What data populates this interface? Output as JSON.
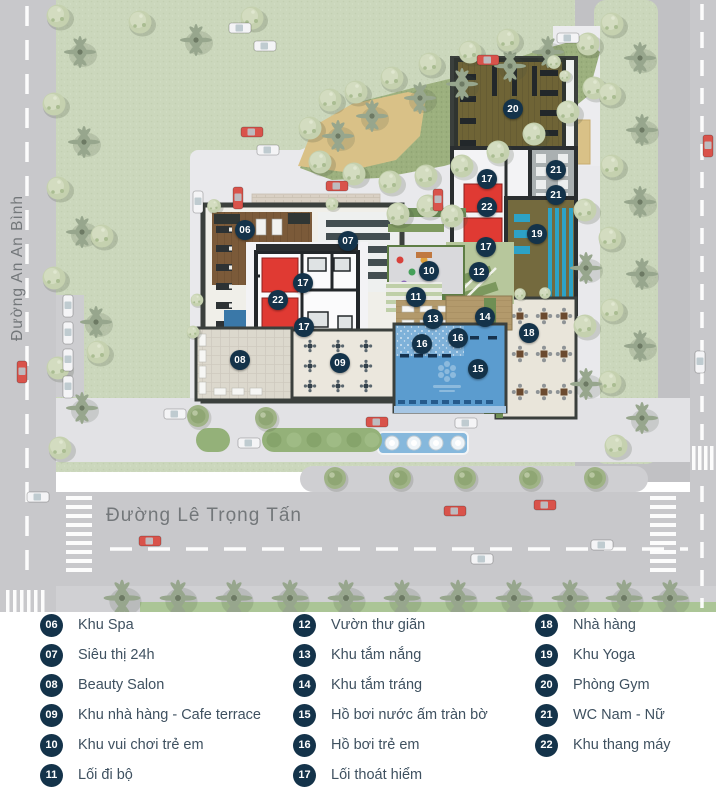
{
  "map": {
    "road_left_label": "Đường An An Bình",
    "road_bottom_label": "Đường Lê Trọng Tấn",
    "markers": [
      {
        "label": "06"
      },
      {
        "label": "07"
      },
      {
        "label": "17"
      },
      {
        "label": "22"
      },
      {
        "label": "17"
      },
      {
        "label": "08"
      },
      {
        "label": "09"
      },
      {
        "label": "20"
      },
      {
        "label": "17"
      },
      {
        "label": "21"
      },
      {
        "label": "21"
      },
      {
        "label": "22"
      },
      {
        "label": "19"
      },
      {
        "label": "17"
      },
      {
        "label": "10"
      },
      {
        "label": "12"
      },
      {
        "label": "11"
      },
      {
        "label": "13"
      },
      {
        "label": "14"
      },
      {
        "label": "16"
      },
      {
        "label": "16"
      },
      {
        "label": "15"
      },
      {
        "label": "18"
      }
    ]
  },
  "legend": {
    "columns": [
      {
        "items": [
          {
            "num": "06",
            "label": "Khu Spa"
          },
          {
            "num": "07",
            "label": "Siêu thị 24h"
          },
          {
            "num": "08",
            "label": "Beauty Salon"
          },
          {
            "num": "09",
            "label": "Khu nhà hàng - Cafe terrace"
          },
          {
            "num": "10",
            "label": "Khu vui chơi trẻ em"
          },
          {
            "num": "11",
            "label": "Lối đi bộ"
          }
        ]
      },
      {
        "items": [
          {
            "num": "12",
            "label": "Vườn thư giãn"
          },
          {
            "num": "13",
            "label": "Khu tắm nắng"
          },
          {
            "num": "14",
            "label": "Khu tắm tráng"
          },
          {
            "num": "15",
            "label": "Hồ bơi nước ấm tràn bờ"
          },
          {
            "num": "16",
            "label": "Hồ bơi trẻ em"
          },
          {
            "num": "17",
            "label": "Lối thoát hiểm"
          }
        ]
      },
      {
        "items": [
          {
            "num": "18",
            "label": "Nhà hàng"
          },
          {
            "num": "19",
            "label": "Khu Yoga"
          },
          {
            "num": "20",
            "label": "Phòng Gym"
          },
          {
            "num": "21",
            "label": "WC Nam - Nữ"
          },
          {
            "num": "22",
            "label": "Khu thang máy"
          }
        ]
      }
    ]
  },
  "colors": {
    "marker_bg": "#14334a",
    "legend_text": "#3f5160",
    "pool_blue": "#5b9ccf",
    "accent_red": "#df3a33",
    "lawn_green": "#cbd7bc",
    "road_gray": "#c8c8cb"
  }
}
